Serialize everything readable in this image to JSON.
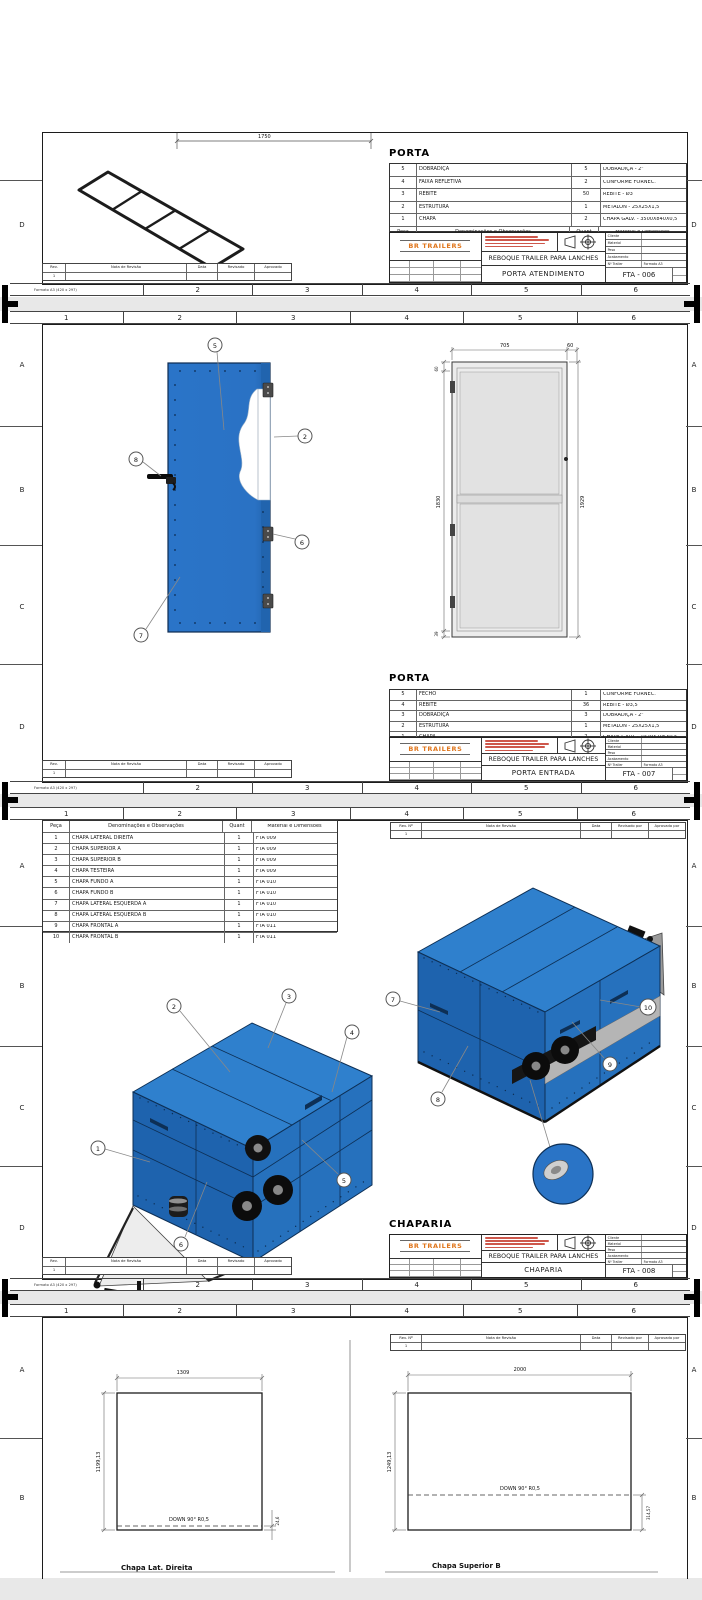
{
  "colors": {
    "accent_blue": "#2a74c8",
    "roof_blue": "#2f80cd",
    "side_blue": "#2671bd",
    "front_blue": "#1e63ae",
    "edge_navy": "#0d2f55",
    "brand_orange": "#e0761c",
    "notice_red": "#c5392b",
    "gap_gray": "#e8e8e8",
    "band_gray": "#b5b5b5"
  },
  "frame": {
    "cols": [
      "1",
      "2",
      "3",
      "4",
      "5",
      "6"
    ],
    "rows_s1": [
      "D"
    ],
    "rows_s2": [
      "A",
      "B",
      "C",
      "D"
    ],
    "rows_s3": [
      "A",
      "B",
      "C",
      "D"
    ],
    "rows_s4": [
      "A",
      "B"
    ],
    "format_note": "Formato A3 (420 x 297)"
  },
  "rev_strip": {
    "c1": "Rev.",
    "c2": "Nota de Revisão",
    "c3": "Data",
    "c4": "Revisado",
    "c5": "Aprovado",
    "first": "1"
  },
  "rev_header": {
    "c1": "Rev. Nº",
    "c2": "Nota de Revisão",
    "c3": "Data",
    "c4": "Revisado por",
    "c5": "Aprovado por",
    "first": "1"
  },
  "titleblock": {
    "brand": "BR TRAILERS",
    "project": "REBOQUE TRAILER PARA LANCHES",
    "f1": "Cliente",
    "f2": "Material",
    "f3": "Peso",
    "f4": "Acabamento",
    "f5": "Nº Trailer",
    "f6": "Formato A3"
  },
  "parts_header": {
    "peca": "Peça",
    "denom": "Denominações e Observações",
    "quant": "Quant",
    "mat": "Material e Dimensões"
  },
  "sheet1": {
    "heading": "PORTA",
    "title": "PORTA ATENDIMENTO",
    "code": "FTA - 006",
    "dim": "1750",
    "parts": [
      {
        "n": "5",
        "d": "DOBRADIÇA",
        "q": "5",
        "m": "DOBRADIÇA - 2\""
      },
      {
        "n": "4",
        "d": "FAIXA REFLETIVA",
        "q": "2",
        "m": "CONFORME FORNEC."
      },
      {
        "n": "3",
        "d": "REBITE",
        "q": "50",
        "m": "REBITE - Ø3"
      },
      {
        "n": "2",
        "d": "ESTRUTURA",
        "q": "1",
        "m": "METALON - 25X25X1,5"
      },
      {
        "n": "1",
        "d": "CHAPA",
        "q": "2",
        "m": "CHAPA GALV. - 3500X840X0,5"
      }
    ]
  },
  "sheet2": {
    "heading": "PORTA",
    "title": "PORTA ENTRADA",
    "code": "FTA - 007",
    "parts": [
      {
        "n": "5",
        "d": "FECHO",
        "q": "1",
        "m": "CONFORME FORNEC."
      },
      {
        "n": "4",
        "d": "REBITE",
        "q": "36",
        "m": "REBITE - Ø3,5"
      },
      {
        "n": "3",
        "d": "DOBRADIÇA",
        "q": "3",
        "m": "DOBRADIÇA - 2\""
      },
      {
        "n": "2",
        "d": "ESTRUTURA",
        "q": "1",
        "m": "METALON - 25X25X1,5"
      },
      {
        "n": "1",
        "d": "CHAPA",
        "q": "2",
        "m": "CHAPA GALV. - 1929X705X0,5"
      }
    ],
    "balloons": [
      "5",
      "2",
      "8",
      "6",
      "7"
    ],
    "door_dims": {
      "w": "705",
      "w2": "60",
      "h_top": "60",
      "h_left": "1830",
      "h_right": "1929",
      "h_bot": "39"
    }
  },
  "sheet3": {
    "heading": "CHAPARIA",
    "title": "CHAPARIA",
    "code": "FTA - 008",
    "parts": [
      {
        "n": "1",
        "d": "CHAPA LATERAL DIREITA",
        "q": "1",
        "m": "FTA 009"
      },
      {
        "n": "2",
        "d": "CHAPA SUPERIOR A",
        "q": "1",
        "m": "FTA 009"
      },
      {
        "n": "3",
        "d": "CHAPA SUPERIOR B",
        "q": "1",
        "m": "FTA 009"
      },
      {
        "n": "4",
        "d": "CHAPA TESTEIRA",
        "q": "1",
        "m": "FTA 009"
      },
      {
        "n": "5",
        "d": "CHAPA FUNDO A",
        "q": "1",
        "m": "FTA 010"
      },
      {
        "n": "6",
        "d": "CHAPA  FUNDO B",
        "q": "1",
        "m": "FTA 010"
      },
      {
        "n": "7",
        "d": "CHAPA  LATERAL ESQUERDA A",
        "q": "1",
        "m": "FTA 010"
      },
      {
        "n": "8",
        "d": "CHAPA  LATERAL ESQUERDA B",
        "q": "1",
        "m": "FTA 010"
      },
      {
        "n": "9",
        "d": "CHAPA  FRONTAL A",
        "q": "1",
        "m": "FTA 011"
      },
      {
        "n": "10",
        "d": "CHAPA  FRONTAL B",
        "q": "1",
        "m": "FTA 011"
      }
    ],
    "balloons": [
      "1",
      "2",
      "3",
      "4",
      "5",
      "6",
      "7",
      "8",
      "9",
      "10"
    ]
  },
  "sheet4": {
    "left": {
      "w": "1309",
      "h": "1199,13",
      "off": "24,6",
      "bend": "DOWN 90° R0,5",
      "caption": "Chapa Lat. Direita"
    },
    "right": {
      "w": "2000",
      "h": "1249,13",
      "off": "314,57",
      "bend": "DOWN 90° R0,5",
      "caption": "Chapa Superior B"
    }
  }
}
